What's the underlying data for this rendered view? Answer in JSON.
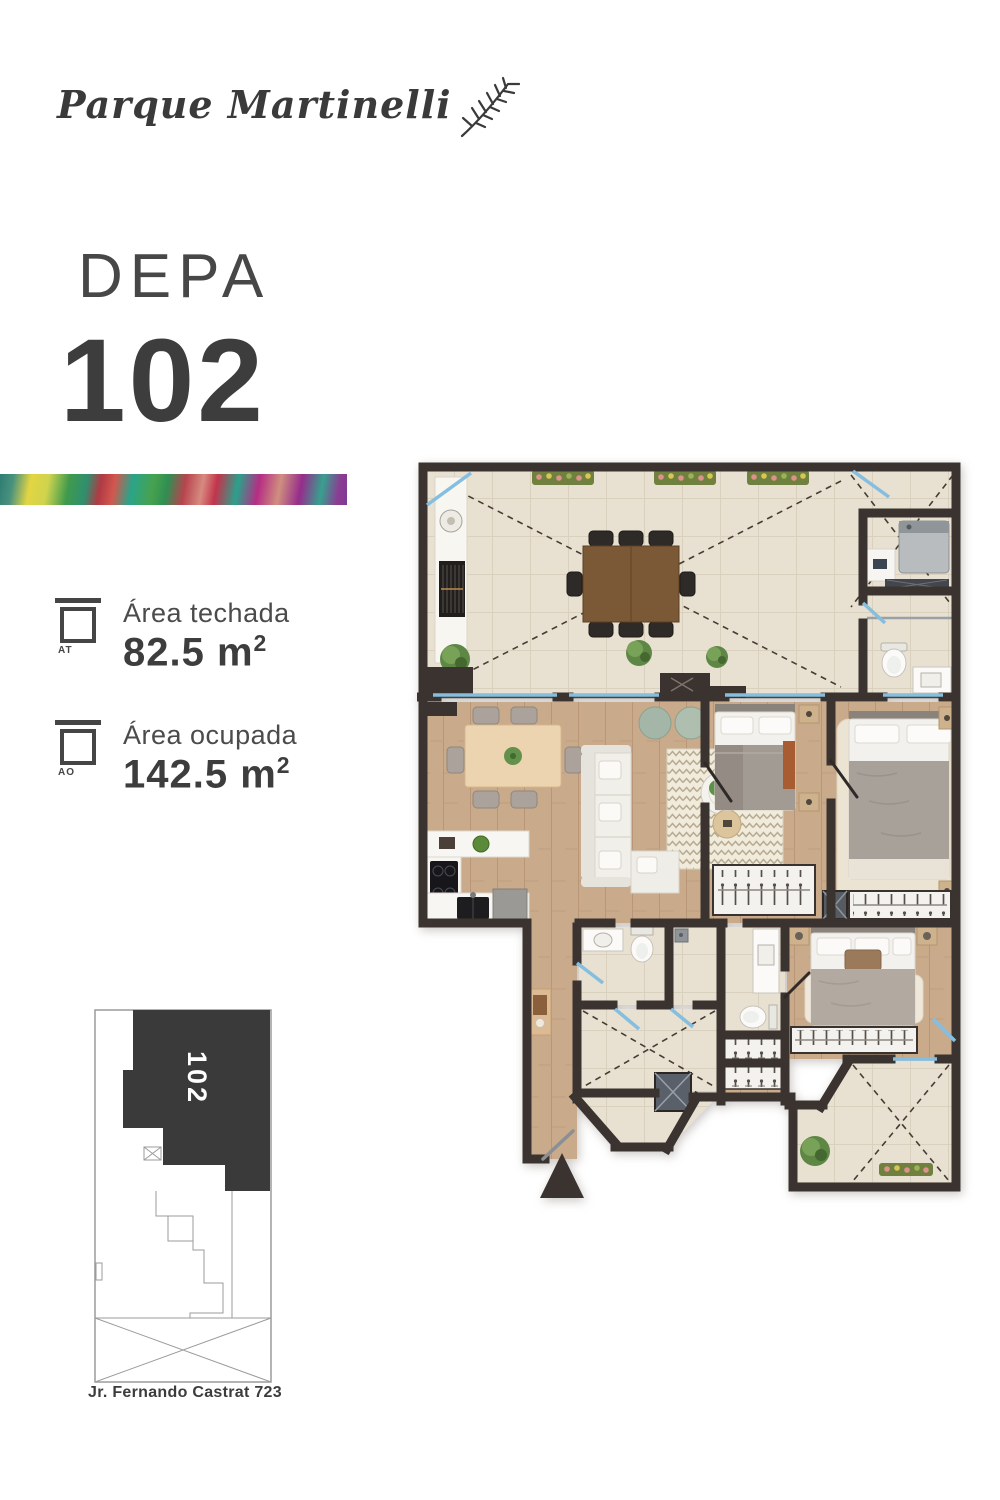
{
  "brand": {
    "name": "Parque Martinelli"
  },
  "unit": {
    "label": "DEPA",
    "number": "102"
  },
  "areas": {
    "items": [
      {
        "icon_label": "AT",
        "name": "Área techada",
        "value": "82.5 m",
        "superscript": "2"
      },
      {
        "icon_label": "AO",
        "name": "Área ocupada",
        "value": "142.5 m",
        "superscript": "2"
      }
    ]
  },
  "site_plan": {
    "unit_number": "102",
    "street_label": "Jr. Fernando Castrat 723"
  },
  "colors": {
    "text_dark": "#3f3e3e",
    "site_unit_fill": "#3a3a3a",
    "wall": "#3a332f",
    "tile_floor": "#e8e1d2",
    "wood_floor": "#c9aa8a",
    "glass": "#85bede",
    "stripe_palette": [
      "#2e7d72",
      "#e3d542",
      "#3f9a4d",
      "#b03a44",
      "#2aa489",
      "#d78a80",
      "#b62d84",
      "#8c3b93"
    ]
  }
}
